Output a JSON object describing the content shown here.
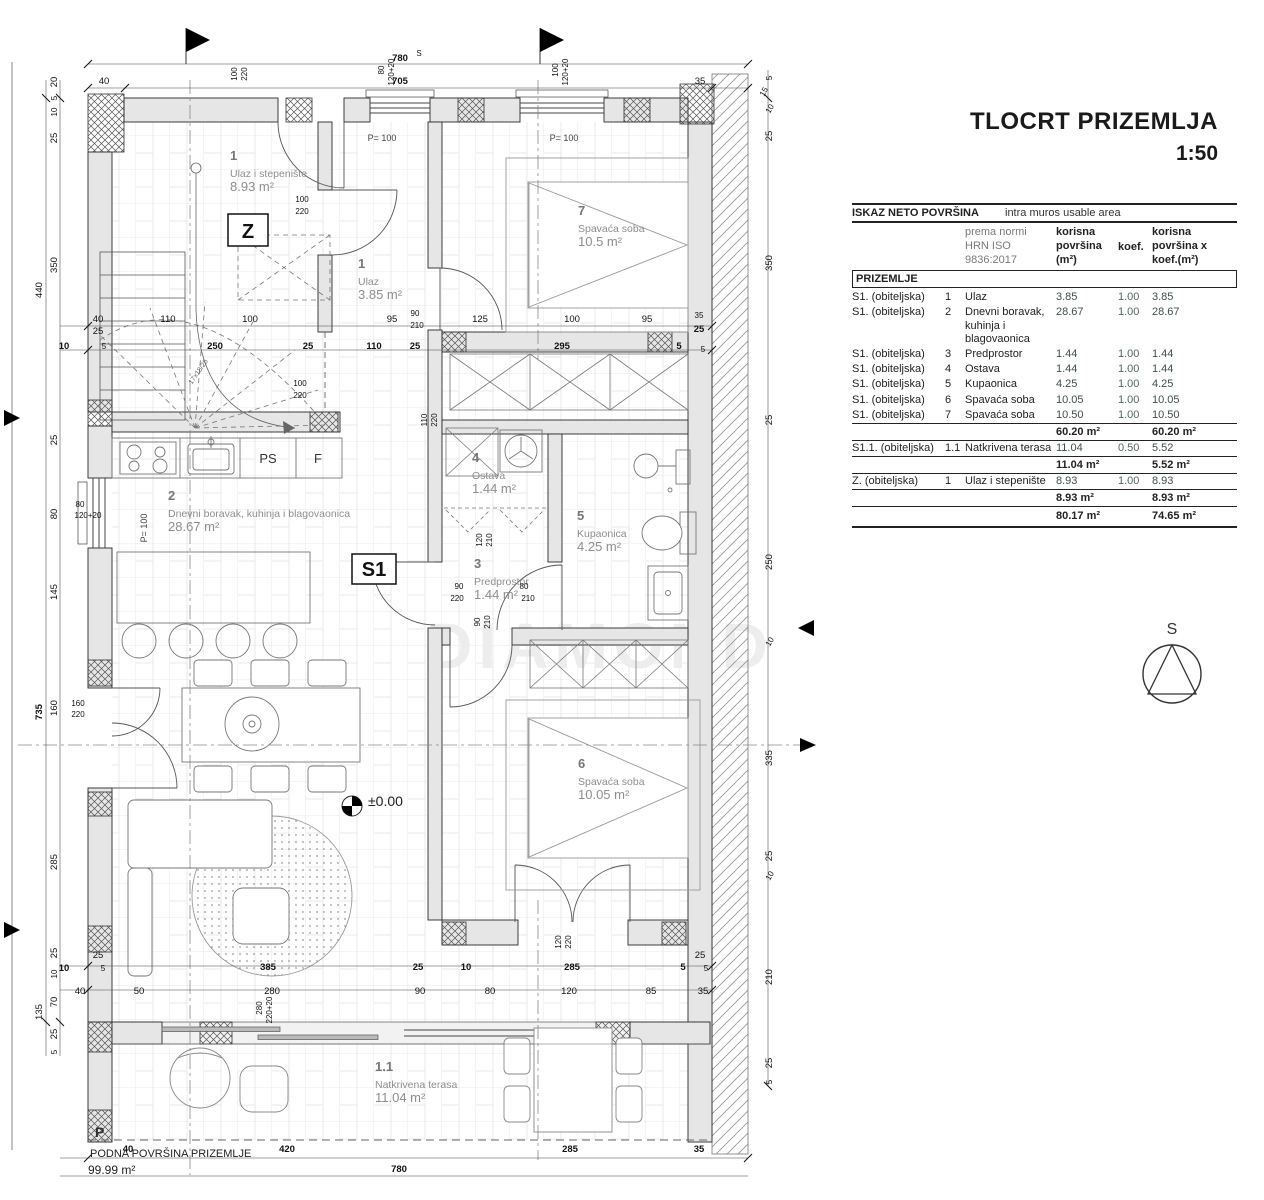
{
  "title": {
    "main": "TLOCRT PRIZEMLJA",
    "scale": "1:50"
  },
  "table": {
    "header_left": "ISKAZ NETO POVRŠINA",
    "header_right": "intra muros usable area",
    "col_norm": "prema normi\nHRN ISO\n9836:2017",
    "col_area": "korisna\npovršina\n(m²)",
    "col_koef": "koef.",
    "col_area_koef": "korisna\npovršina x\nkoef.(m²)",
    "section": "PRIZEMLJE",
    "rows": [
      {
        "unit": "S1. (obiteljska)",
        "no": "1",
        "name": "Ulaz",
        "area": "3.85",
        "koef": "1.00",
        "areakoef": "3.85"
      },
      {
        "unit": "S1. (obiteljska)",
        "no": "2",
        "name": "Dnevni boravak, kuhinja i blagovaonica",
        "area": "28.67",
        "koef": "1.00",
        "areakoef": "28.67"
      },
      {
        "unit": "S1. (obiteljska)",
        "no": "3",
        "name": "Predprostor",
        "area": "1.44",
        "koef": "1.00",
        "areakoef": "1.44"
      },
      {
        "unit": "S1. (obiteljska)",
        "no": "4",
        "name": "Ostava",
        "area": "1.44",
        "koef": "1.00",
        "areakoef": "1.44"
      },
      {
        "unit": "S1. (obiteljska)",
        "no": "5",
        "name": "Kupaonica",
        "area": "4.25",
        "koef": "1.00",
        "areakoef": "4.25"
      },
      {
        "unit": "S1. (obiteljska)",
        "no": "6",
        "name": "Spavaća soba",
        "area": "10.05",
        "koef": "1.00",
        "areakoef": "10.05"
      },
      {
        "unit": "S1. (obiteljska)",
        "no": "7",
        "name": "Spavaća soba",
        "area": "10.50",
        "koef": "1.00",
        "areakoef": "10.50"
      }
    ],
    "subtotal1": {
      "area": "60.20 m²",
      "areakoef": "60.20 m²"
    },
    "row_s11": {
      "unit": "S1.1. (obiteljska)",
      "no": "1.1",
      "name": "Natkrivena terasa",
      "area": "11.04",
      "koef": "0.50",
      "areakoef": "5.52"
    },
    "subtotal2": {
      "area": "11.04 m²",
      "areakoef": "5.52 m²"
    },
    "row_z": {
      "unit": "Z. (obiteljska)",
      "no": "1",
      "name": "Ulaz i stepenište",
      "area": "8.93",
      "koef": "1.00",
      "areakoef": "8.93"
    },
    "subtotal3": {
      "area": "8.93 m²",
      "areakoef": "8.93 m²"
    },
    "total": {
      "area": "80.17 m²",
      "areakoef": "74.65 m²"
    }
  },
  "compass": {
    "label": "S"
  },
  "plan": {
    "watermark": "DIAMOND",
    "level_marker": "±0.00",
    "rooms": [
      {
        "num": "1",
        "name": "Ulaz i stepenište",
        "area": "8.93 m²",
        "x": 230,
        "y": 160
      },
      {
        "num": "1",
        "name": "Ulaz",
        "area": "3.85 m²",
        "x": 358,
        "y": 268
      },
      {
        "num": "7",
        "name": "Spavaća soba",
        "area": "10.5 m²",
        "x": 578,
        "y": 215
      },
      {
        "num": "4",
        "name": "Ostava",
        "area": "1.44 m²",
        "x": 472,
        "y": 462
      },
      {
        "num": "5",
        "name": "Kupaonica",
        "area": "4.25 m²",
        "x": 577,
        "y": 520
      },
      {
        "num": "3",
        "name": "Predprostor",
        "area": "1.44 m²",
        "x": 474,
        "y": 568
      },
      {
        "num": "2",
        "name": "Dnevni boravak, kuhinja i blagovaonica",
        "area": "28.67 m²",
        "x": 168,
        "y": 500
      },
      {
        "num": "6",
        "name": "Spavaća soba",
        "area": "10.05 m²",
        "x": 578,
        "y": 768
      },
      {
        "num": "1.1",
        "name": "Natkrivena terasa",
        "area": "11.04 m²",
        "x": 375,
        "y": 1071
      }
    ],
    "boxes": [
      {
        "label": "Z",
        "x": 228,
        "y": 214,
        "w": 40,
        "h": 32
      },
      {
        "label": "S1",
        "x": 352,
        "y": 554,
        "w": 44,
        "h": 30
      }
    ],
    "labels": [
      {
        "t": "±0.00",
        "x": 368,
        "y": 806,
        "s": 14,
        "c": "#222",
        "a": "start"
      },
      {
        "t": "P= 100",
        "x": 382,
        "y": 141,
        "s": 9,
        "c": "#444"
      },
      {
        "t": "P= 100",
        "x": 564,
        "y": 141,
        "s": 9,
        "c": "#444"
      },
      {
        "t": "P= 100",
        "x": 147,
        "y": 528,
        "s": 9,
        "c": "#444",
        "r": -90
      },
      {
        "t": "PS",
        "x": 268,
        "y": 463,
        "s": 13,
        "c": "#333"
      },
      {
        "t": "F",
        "x": 318,
        "y": 463,
        "s": 13,
        "c": "#333"
      },
      {
        "t": "17x18/25",
        "x": 200,
        "y": 373,
        "s": 7,
        "c": "#666",
        "r": -55
      },
      {
        "t": "P",
        "x": 95,
        "y": 1137,
        "s": 14,
        "c": "#333",
        "b": 1,
        "a": "start"
      },
      {
        "t": "PODNA POVRŠINA PRIZEMLJE",
        "x": 90,
        "y": 1157,
        "s": 11,
        "c": "#222",
        "a": "start"
      },
      {
        "t": "99.99 m²",
        "x": 88,
        "y": 1174,
        "s": 12,
        "c": "#222",
        "a": "start"
      }
    ],
    "dims": [
      {
        "t": "780",
        "x": 400,
        "y": 61,
        "b": 1
      },
      {
        "t": "S",
        "x": 419,
        "y": 56,
        "s": 8
      },
      {
        "t": "40",
        "x": 104,
        "y": 84
      },
      {
        "t": "705",
        "x": 400,
        "y": 84,
        "b": 1
      },
      {
        "t": "35",
        "x": 700,
        "y": 84
      },
      {
        "t": "100",
        "x": 237,
        "y": 74,
        "r": -90,
        "s": 8
      },
      {
        "t": "220",
        "x": 247,
        "y": 74,
        "r": -90,
        "s": 8
      },
      {
        "t": "80",
        "x": 384,
        "y": 70,
        "r": -90,
        "s": 8
      },
      {
        "t": "120+20",
        "x": 394,
        "y": 72,
        "r": -90,
        "s": 8
      },
      {
        "t": "100",
        "x": 558,
        "y": 70,
        "r": -90,
        "s": 8
      },
      {
        "t": "120+20",
        "x": 568,
        "y": 72,
        "r": -90,
        "s": 8
      },
      {
        "t": "20",
        "x": 57,
        "y": 82,
        "r": -90
      },
      {
        "t": "5",
        "x": 57,
        "y": 98,
        "r": -90,
        "s": 8
      },
      {
        "t": "10",
        "x": 57,
        "y": 112,
        "r": -90,
        "s": 8
      },
      {
        "t": "25",
        "x": 57,
        "y": 138,
        "r": -90
      },
      {
        "t": "350",
        "x": 57,
        "y": 265,
        "r": -90
      },
      {
        "t": "25",
        "x": 57,
        "y": 440,
        "r": -90
      },
      {
        "t": "80",
        "x": 57,
        "y": 514,
        "r": -90
      },
      {
        "t": "145",
        "x": 57,
        "y": 592,
        "r": -90
      },
      {
        "t": "160",
        "x": 57,
        "y": 708,
        "r": -90
      },
      {
        "t": "285",
        "x": 57,
        "y": 862,
        "r": -90
      },
      {
        "t": "25",
        "x": 57,
        "y": 953,
        "r": -90
      },
      {
        "t": "10",
        "x": 57,
        "y": 974,
        "r": -90,
        "s": 8
      },
      {
        "t": "70",
        "x": 57,
        "y": 1002,
        "r": -90
      },
      {
        "t": "25",
        "x": 57,
        "y": 1034,
        "r": -90
      },
      {
        "t": "5",
        "x": 57,
        "y": 1052,
        "r": -90,
        "s": 8
      },
      {
        "t": "440",
        "x": 42,
        "y": 290,
        "r": -90
      },
      {
        "t": "735",
        "x": 42,
        "y": 712,
        "r": -90,
        "b": 1
      },
      {
        "t": "135",
        "x": 42,
        "y": 1012,
        "r": -90
      },
      {
        "t": "160",
        "x": 78,
        "y": 706,
        "s": 8
      },
      {
        "t": "220",
        "x": 78,
        "y": 717,
        "s": 8
      },
      {
        "t": "80",
        "x": 80,
        "y": 507,
        "s": 8
      },
      {
        "t": "120+20",
        "x": 88,
        "y": 518,
        "s": 8
      },
      {
        "t": "5",
        "x": 772,
        "y": 78,
        "r": -90,
        "s": 8
      },
      {
        "t": "15",
        "x": 766,
        "y": 93,
        "r": -60,
        "s": 8
      },
      {
        "t": "10",
        "x": 772,
        "y": 110,
        "r": -60,
        "s": 8
      },
      {
        "t": "25",
        "x": 772,
        "y": 136,
        "r": -90
      },
      {
        "t": "350",
        "x": 772,
        "y": 263,
        "r": -90
      },
      {
        "t": "25",
        "x": 772,
        "y": 420,
        "r": -90
      },
      {
        "t": "250",
        "x": 772,
        "y": 562,
        "r": -90
      },
      {
        "t": "10",
        "x": 772,
        "y": 643,
        "r": -60,
        "s": 8
      },
      {
        "t": "335",
        "x": 772,
        "y": 758,
        "r": -90
      },
      {
        "t": "25",
        "x": 772,
        "y": 856,
        "r": -90
      },
      {
        "t": "10",
        "x": 772,
        "y": 877,
        "r": -60,
        "s": 8
      },
      {
        "t": "210",
        "x": 772,
        "y": 977,
        "r": -90
      },
      {
        "t": "25",
        "x": 772,
        "y": 1063,
        "r": -90
      },
      {
        "t": "5",
        "x": 772,
        "y": 1082,
        "r": -90,
        "s": 8
      },
      {
        "t": "40",
        "x": 98,
        "y": 322
      },
      {
        "t": "25",
        "x": 98,
        "y": 334
      },
      {
        "t": "110",
        "x": 168,
        "y": 322
      },
      {
        "t": "100",
        "x": 250,
        "y": 322
      },
      {
        "t": "95",
        "x": 392,
        "y": 322
      },
      {
        "t": "90",
        "x": 415,
        "y": 316,
        "s": 8
      },
      {
        "t": "210",
        "x": 417,
        "y": 328,
        "s": 8
      },
      {
        "t": "125",
        "x": 480,
        "y": 322
      },
      {
        "t": "100",
        "x": 572,
        "y": 322
      },
      {
        "t": "95",
        "x": 647,
        "y": 322
      },
      {
        "t": "35",
        "x": 699,
        "y": 318,
        "s": 8
      },
      {
        "t": "25",
        "x": 699,
        "y": 332,
        "b": 1
      },
      {
        "t": "10",
        "x": 64,
        "y": 349,
        "b": 1
      },
      {
        "t": "5",
        "x": 104,
        "y": 349,
        "s": 8
      },
      {
        "t": "250",
        "x": 215,
        "y": 349,
        "b": 1
      },
      {
        "t": "25",
        "x": 308,
        "y": 349,
        "b": 1
      },
      {
        "t": "110",
        "x": 374,
        "y": 349,
        "b": 1
      },
      {
        "t": "25",
        "x": 415,
        "y": 349,
        "b": 1
      },
      {
        "t": "295",
        "x": 562,
        "y": 349,
        "b": 1
      },
      {
        "t": "5",
        "x": 679,
        "y": 349,
        "b": 1
      },
      {
        "t": "5",
        "x": 703,
        "y": 352,
        "s": 8
      },
      {
        "t": "100",
        "x": 302,
        "y": 202,
        "s": 8
      },
      {
        "t": "220",
        "x": 302,
        "y": 214,
        "s": 8
      },
      {
        "t": "100",
        "x": 300,
        "y": 386,
        "s": 8
      },
      {
        "t": "220",
        "x": 300,
        "y": 398,
        "s": 8
      },
      {
        "t": "110",
        "x": 427,
        "y": 420,
        "r": -90,
        "s": 8
      },
      {
        "t": "220",
        "x": 437,
        "y": 420,
        "r": -90,
        "s": 8
      },
      {
        "t": "120",
        "x": 482,
        "y": 540,
        "r": -90,
        "s": 8
      },
      {
        "t": "210",
        "x": 492,
        "y": 540,
        "r": -90,
        "s": 8
      },
      {
        "t": "90",
        "x": 459,
        "y": 589,
        "s": 8
      },
      {
        "t": "220",
        "x": 457,
        "y": 601,
        "s": 8
      },
      {
        "t": "80",
        "x": 524,
        "y": 589,
        "s": 8
      },
      {
        "t": "210",
        "x": 528,
        "y": 601,
        "s": 8
      },
      {
        "t": "90",
        "x": 480,
        "y": 622,
        "r": -90,
        "s": 8
      },
      {
        "t": "210",
        "x": 490,
        "y": 622,
        "r": -90,
        "s": 8
      },
      {
        "t": "120",
        "x": 561,
        "y": 942,
        "r": -90,
        "s": 8
      },
      {
        "t": "220",
        "x": 571,
        "y": 942,
        "r": -90,
        "s": 8
      },
      {
        "t": "280",
        "x": 262,
        "y": 1008,
        "r": -90,
        "s": 8
      },
      {
        "t": "220+20",
        "x": 272,
        "y": 1010,
        "r": -90,
        "s": 8
      },
      {
        "t": "10",
        "x": 64,
        "y": 971,
        "b": 1
      },
      {
        "t": "25",
        "x": 98,
        "y": 958
      },
      {
        "t": "5",
        "x": 103,
        "y": 971,
        "s": 8
      },
      {
        "t": "385",
        "x": 268,
        "y": 970,
        "b": 1
      },
      {
        "t": "25",
        "x": 418,
        "y": 970,
        "b": 1
      },
      {
        "t": "10",
        "x": 466,
        "y": 970,
        "b": 1
      },
      {
        "t": "285",
        "x": 572,
        "y": 970,
        "b": 1
      },
      {
        "t": "5",
        "x": 683,
        "y": 970,
        "b": 1
      },
      {
        "t": "25",
        "x": 700,
        "y": 958
      },
      {
        "t": "5",
        "x": 706,
        "y": 971,
        "s": 8
      },
      {
        "t": "40",
        "x": 80,
        "y": 994
      },
      {
        "t": "50",
        "x": 139,
        "y": 994
      },
      {
        "t": "280",
        "x": 272,
        "y": 994
      },
      {
        "t": "90",
        "x": 420,
        "y": 994
      },
      {
        "t": "80",
        "x": 490,
        "y": 994
      },
      {
        "t": "120",
        "x": 569,
        "y": 994
      },
      {
        "t": "85",
        "x": 651,
        "y": 994
      },
      {
        "t": "35",
        "x": 703,
        "y": 994
      },
      {
        "t": "40",
        "x": 128,
        "y": 1152,
        "b": 1
      },
      {
        "t": "420",
        "x": 287,
        "y": 1152,
        "b": 1
      },
      {
        "t": "285",
        "x": 570,
        "y": 1152,
        "b": 1
      },
      {
        "t": "35",
        "x": 699,
        "y": 1152,
        "b": 1
      },
      {
        "t": "780",
        "x": 399,
        "y": 1172,
        "b": 1
      }
    ]
  }
}
